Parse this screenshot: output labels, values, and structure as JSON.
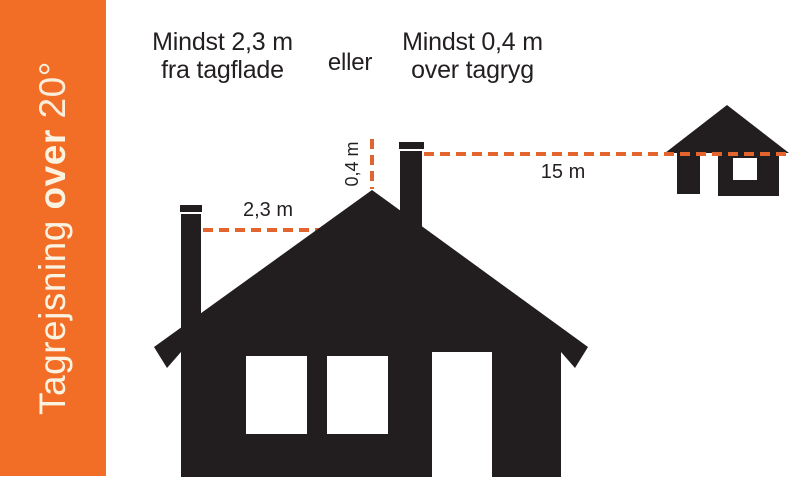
{
  "sidebar": {
    "title_regular": "Tagrejsning",
    "title_bold": "over",
    "title_light": "20°"
  },
  "header": {
    "option1_line1": "Mindst 2,3 m",
    "option1_line2": "fra tagflade",
    "conjunction": "eller",
    "option2_line1": "Mindst 0,4 m",
    "option2_line2": "over tagryg"
  },
  "measurements": {
    "from_roof_surface": "2,3 m",
    "above_ridge": "0,4 m",
    "distance_to_neighbor": "15 m"
  },
  "colors": {
    "sidebar_bg": "#F26E27",
    "sidebar_text": "#FBF3E2",
    "silhouette": "#221E1F",
    "dash": "#E2642F",
    "heading_text": "#231F20"
  }
}
